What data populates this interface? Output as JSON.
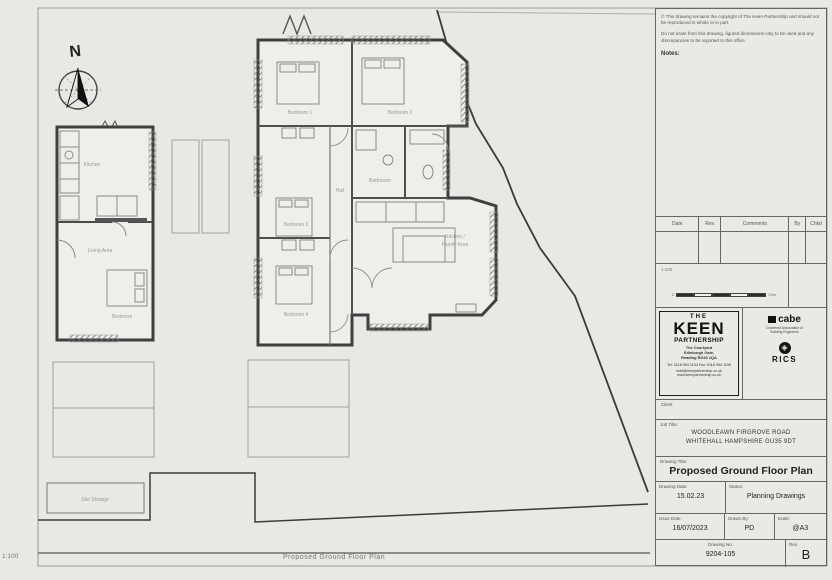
{
  "sheet": {
    "north_label": "N",
    "footer_scale": "1:100",
    "footer_title": "Proposed Ground Floor Plan"
  },
  "disclaimer": {
    "para1": "© This drawing remains the copyright of The Keen Partnership and should not be reproduced in whole or in part.",
    "para2": "Do not scale from this drawing, figured dimensions only to be used and any discrepancies to be reported to this office.",
    "notes_label": "Notes:"
  },
  "revision_table": {
    "headers": {
      "date": "Date",
      "rev": "Rev",
      "comments": "Comments",
      "by": "By",
      "chkd": "Chkd"
    }
  },
  "scale_bar": {
    "label": "1:100",
    "start": "0",
    "end": "10m"
  },
  "firm": {
    "the": "THE",
    "name": "KEEN",
    "partnership": "PARTNERSHIP",
    "address1": "The Courtyard",
    "address2": "Edinburgh Gate,",
    "address3": "Reading RG30 2QA",
    "tel_fax": "Tel: 0118 954 1194   Fax: 0118 954 1196",
    "email_web": "mail@keenpartnership.co.uk   www.keenpartnership.co.uk",
    "client_label": "Client"
  },
  "accreditation": {
    "cabe": "cabe",
    "cabe_sub1": "Chartered Association of",
    "cabe_sub2": "Building Engineers",
    "rics_glyph": "◈",
    "rics": "RICS"
  },
  "title_block": {
    "job_title_label": "Job Title:",
    "job_title_line1": "WOODLEAWN FIRGROVE ROAD",
    "job_title_line2": "WHITEHALL HAMPSHIRE GU35 9DT",
    "drawing_title_label": "Drawing Title:",
    "drawing_title": "Proposed Ground Floor Plan",
    "drawing_date_label": "Drawing Date:",
    "drawing_date": "15.02.23",
    "status_label": "Status:",
    "status": "Planning Drawings",
    "issue_date_label": "Issue Date:",
    "issue_date": "16/07/2023",
    "drawn_by_label": "Drawn By:",
    "drawn_by": "PD",
    "scale_label": "Scale:",
    "scale": "@A3",
    "drawing_no_label": "Drawing No:",
    "drawing_no": "9204-105",
    "rev_label": "Rev:",
    "rev": "B"
  },
  "plan": {
    "rooms": [
      {
        "label": "Bedroom 1"
      },
      {
        "label": "Bedroom 2"
      },
      {
        "label": "Bedroom 3"
      },
      {
        "label": "Bedroom 4"
      },
      {
        "label": "Bathroom"
      },
      {
        "label": "Hall"
      },
      {
        "label": "Kitchen /"
      },
      {
        "label": "Family Area"
      },
      {
        "label": "Kitchen"
      },
      {
        "label": "Living Area"
      },
      {
        "label": "Bedroom"
      }
    ],
    "site_storage": "Site Storage"
  },
  "colors": {
    "paper": "#e9e8e5",
    "wall": "#3f3f3f",
    "boundary": "#3a3a3a",
    "faint": "#9a9a9a"
  }
}
